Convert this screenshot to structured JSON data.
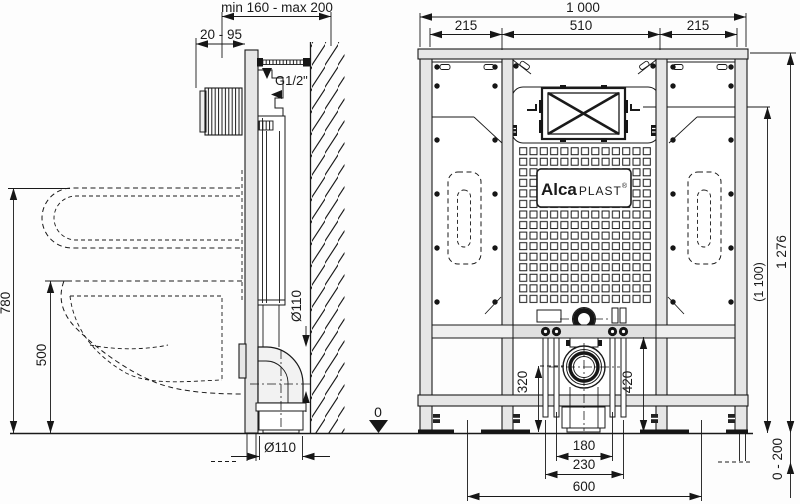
{
  "drawing": {
    "type": "installation frame technical drawing",
    "colors": {
      "line": "#1a1a1a",
      "metal_fill": "#e6e6e6",
      "background": "#ffffff"
    }
  },
  "side_view": {
    "dims": {
      "depth_range": "min 160 - max 200",
      "block_range": "20 - 95",
      "inlet_thread": "G1/2\"",
      "height_780": "780",
      "height_500": "500",
      "pipe_dia_side": "Ø110",
      "pipe_dia_bottom": "Ø110",
      "datum_zero": "0"
    }
  },
  "front_view": {
    "dims": {
      "width_total": "1 000",
      "width_left": "215",
      "width_center": "510",
      "width_right": "215",
      "height_total": "1 276",
      "height_flush": "(1 100)",
      "leg_range": "0 - 200",
      "outlet_height": "320",
      "rail_height": "420",
      "rod_spacing": "180",
      "bolt_spacing": "230",
      "base_width": "600"
    },
    "logo": {
      "brand_bold": "Alca",
      "brand_light": "PLAST",
      "registered": "®"
    }
  }
}
